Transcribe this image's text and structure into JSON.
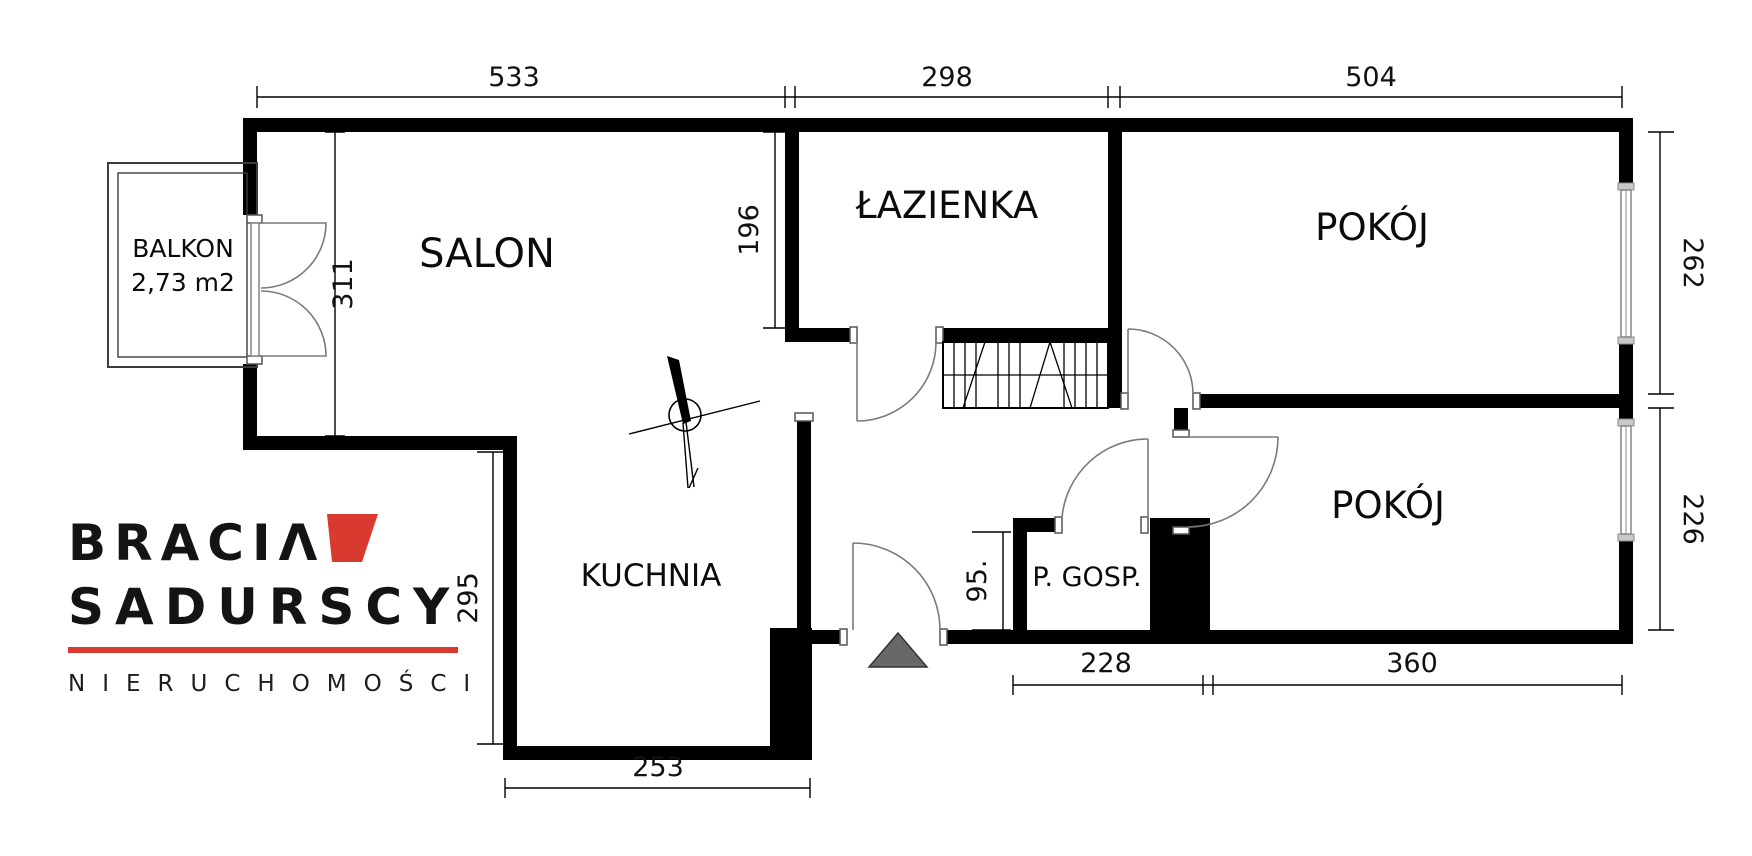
{
  "title": "Rzut mieszkania - plan",
  "rooms": {
    "salon": {
      "label": "SALON"
    },
    "bathroom": {
      "label": "ŁAZIENKA"
    },
    "room_top": {
      "label": "POKÓJ"
    },
    "room_bottom": {
      "label": "POKÓJ"
    },
    "kitchen": {
      "label": "KUCHNIA"
    },
    "utility": {
      "label": "P. GOSP."
    },
    "balcony": {
      "label": "BALKON",
      "area": "2,73 m2"
    }
  },
  "dimensions": {
    "top_salon": "533",
    "top_bathroom": "298",
    "top_room": "504",
    "salon_height": "311",
    "bathroom_height": "196",
    "kitchen_height": "295",
    "kitchen_width": "253",
    "utility_height": "95.",
    "bottom_utility": "228",
    "bottom_room": "360",
    "room_top_height": "262",
    "room_bottom_height": "226"
  },
  "logo": {
    "line1": "BRACIΛ",
    "line2": "SADURSCY",
    "line3": "NIERUCHOMOŚCI",
    "accent_color": "#d93a30"
  },
  "symbols": {
    "north_arrow": "north-arrow",
    "entrance_marker": "entrance-triangle",
    "wardrobe": "wardrobe-hatch"
  },
  "colors": {
    "wall": "#000000",
    "door": "#7a7a7a",
    "logo_red": "#d93a30",
    "entrance_gray": "#686868"
  }
}
